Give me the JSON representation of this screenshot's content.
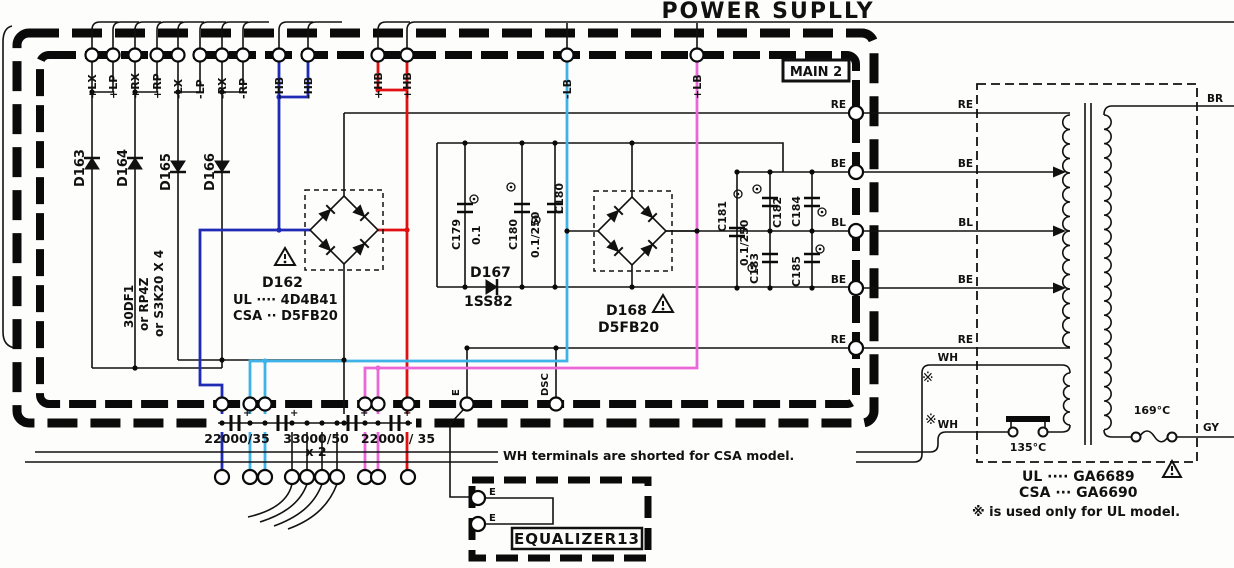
{
  "title": "POWER SUPLLY",
  "board": {
    "name": "MAIN 2"
  },
  "top_terminals": {
    "labels": [
      "+LX",
      "+LP",
      "+RX",
      "+RP",
      "-LX",
      "-LP",
      "-RX",
      "-RP",
      "-HB",
      "-HB",
      "+HB",
      "+HB",
      "-LB",
      "+LB"
    ]
  },
  "diodes": {
    "d163": "D163",
    "d164": "D164",
    "d165": "D165",
    "d166": "D166",
    "alt": [
      "30DF1",
      "or RP4Z",
      "or S3K20 X 4"
    ],
    "d162": {
      "name": "D162",
      "ul": "UL ···· 4D4B41",
      "csa": "CSA ·· D5FB20"
    },
    "d167": {
      "name": "D167",
      "part": "1SS82"
    },
    "d168": {
      "name": "D168",
      "part": "D5FB20"
    }
  },
  "capacitors": {
    "c179": {
      "name": "C179",
      "value": "0.1"
    },
    "c180a": {
      "name": "C180",
      "value": "0.1/250"
    },
    "c180b": {
      "name": "C180"
    },
    "c181": {
      "name": "C181",
      "value": "0.1/250"
    },
    "c182": {
      "name": "C182"
    },
    "c183": {
      "name": "C183"
    },
    "c184": {
      "name": "C184"
    },
    "c185": {
      "name": "C185"
    }
  },
  "filter_caps": {
    "plus": "+",
    "labels": [
      "22000/35",
      "33000/50",
      "x 2",
      "22000 / 35"
    ]
  },
  "ground": {
    "e": "E",
    "dsc": "DSC"
  },
  "right_terminals": [
    "RE",
    "BE",
    "BL",
    "BE",
    "RE"
  ],
  "transformer": {
    "primary_labels": [
      "RE",
      "BE",
      "BL",
      "BE",
      "RE"
    ],
    "wh": [
      "WH",
      "WH"
    ],
    "asterisk": "※",
    "secondary_labels": [
      "BR",
      "GY"
    ],
    "thermal_switch": "135°C",
    "thermal_fuse": "169°C",
    "ul": "UL ···· GA6689",
    "csa": "CSA ··· GA6690",
    "note": "※ is used only for UL model."
  },
  "notes": {
    "wh_note": "WH terminals are shorted for CSA model."
  },
  "equalizer": {
    "name": "EQUALIZER13",
    "terminals": [
      "E",
      "E"
    ]
  },
  "colors": {
    "blue": "#1f2bb5",
    "cyan": "#3fb3e8",
    "magenta": "#e967d6",
    "red": "#e01010"
  }
}
